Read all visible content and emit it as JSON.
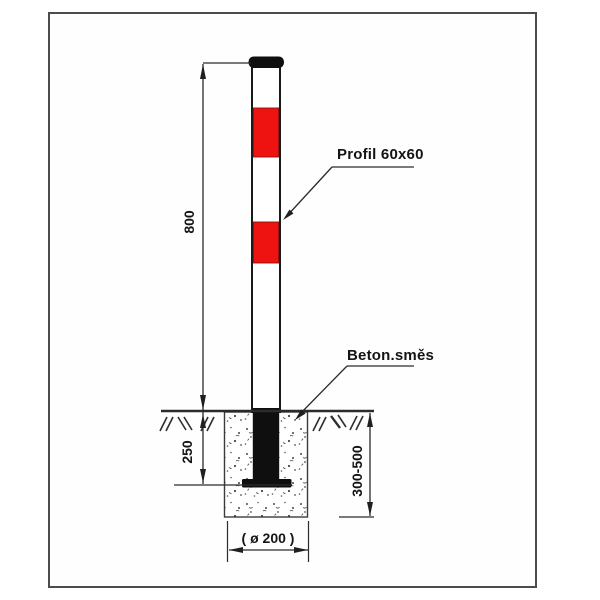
{
  "diagram": {
    "callouts": {
      "profile": "Profil 60x60",
      "concrete": "Beton.směs"
    },
    "dimensions": {
      "height_above_ground": "800",
      "embedment_depth": "250",
      "foundation_depth": "300-500",
      "foundation_width": "( ø 200 )"
    },
    "colors": {
      "stripe_red": "#ee1310",
      "stripe_edge": "#8d1210",
      "post_black": "#101010",
      "line": "#2b2b2b"
    }
  }
}
